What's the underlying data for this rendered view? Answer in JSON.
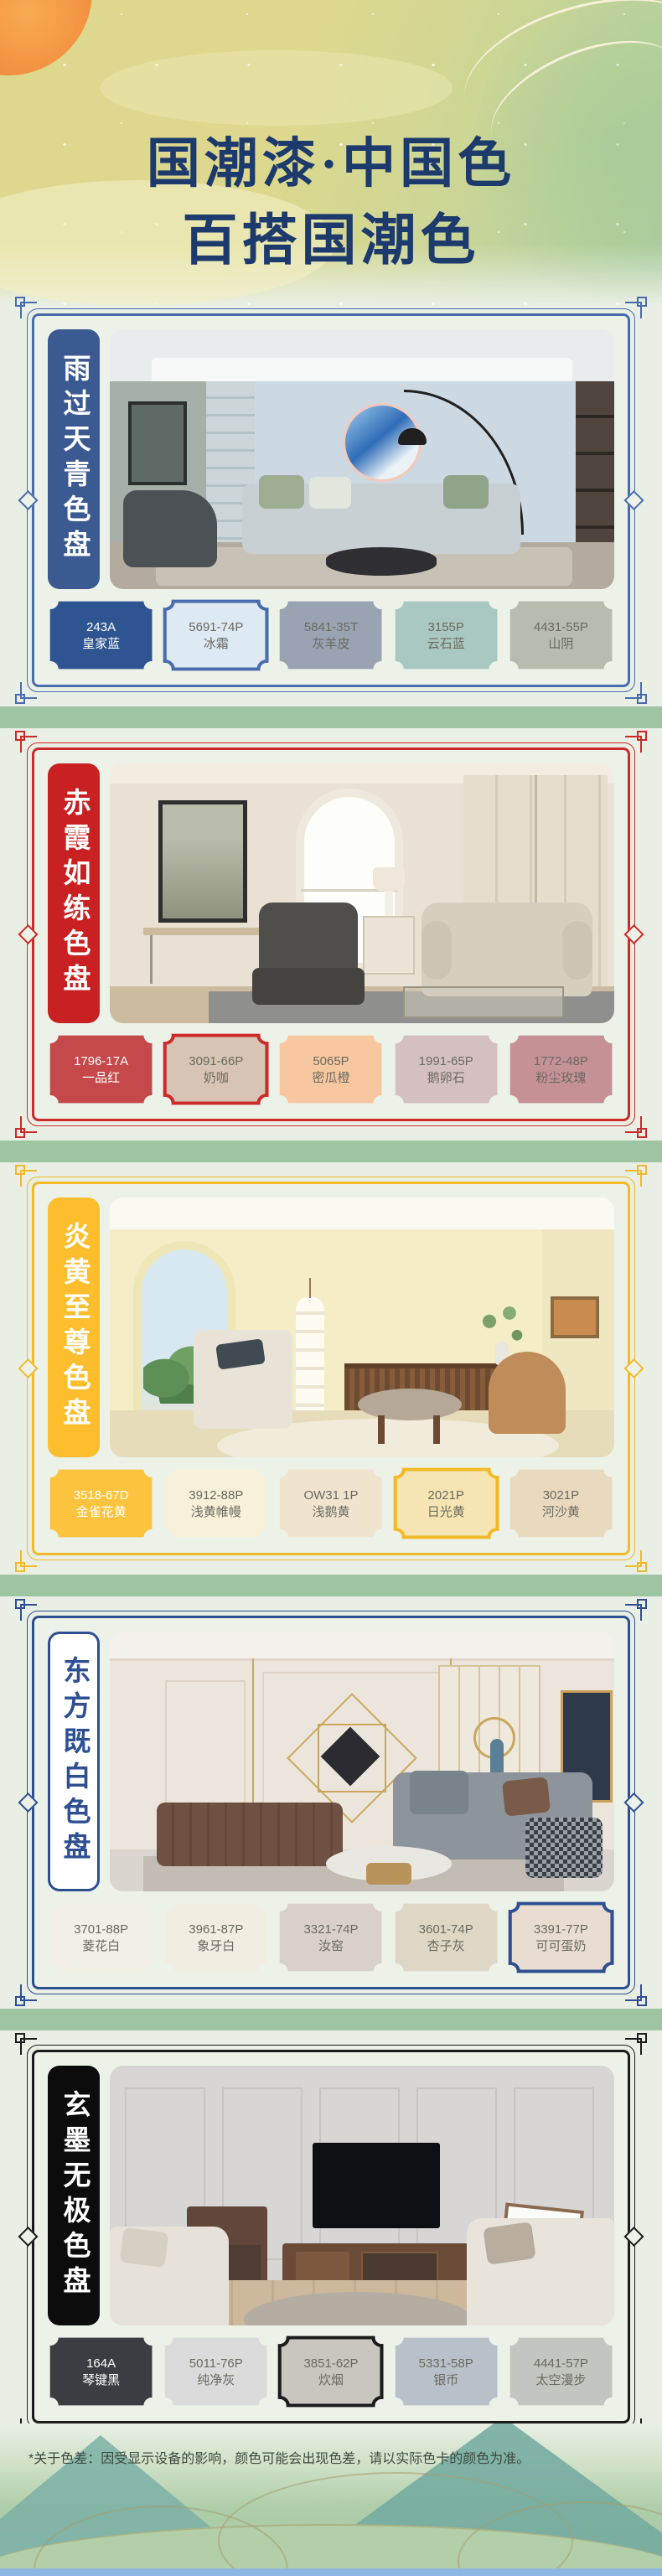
{
  "header": {
    "title_line1": "国潮漆·中国色",
    "title_line2": "百搭国潮色",
    "title_color": "#1d3a6d"
  },
  "sections": [
    {
      "title": "雨过天青色盘",
      "accent_color": "#4a6cae",
      "banner_bg": "#3b5a91",
      "banner_text_color": "#ffffff",
      "swatches": [
        {
          "code": "243A",
          "label": "皇家蓝",
          "color": "#2e5591",
          "text": "light",
          "highlighted": false
        },
        {
          "code": "5691-74P",
          "label": "冰霜",
          "color": "#dde9f3",
          "text": "dark",
          "highlighted": true
        },
        {
          "code": "5841-35T",
          "label": "灰羊皮",
          "color": "#99a3b1",
          "text": "dark",
          "highlighted": false
        },
        {
          "code": "3155P",
          "label": "云石蓝",
          "color": "#a9c8c1",
          "text": "dark",
          "highlighted": false
        },
        {
          "code": "4431-55P",
          "label": "山阴",
          "color": "#b7bcae",
          "text": "dark",
          "highlighted": false
        }
      ]
    },
    {
      "title": "赤霞如练色盘",
      "accent_color": "#cd2a2a",
      "banner_bg": "#c92121",
      "banner_text_color": "#ffffff",
      "swatches": [
        {
          "code": "1796-17A",
          "label": "一品红",
          "color": "#c5494b",
          "text": "light",
          "highlighted": false
        },
        {
          "code": "3091-66P",
          "label": "奶咖",
          "color": "#d8c4b5",
          "text": "dark",
          "highlighted": true
        },
        {
          "code": "5065P",
          "label": "密瓜橙",
          "color": "#f7c8a0",
          "text": "dark",
          "highlighted": false
        },
        {
          "code": "1991-65P",
          "label": "鹅卵石",
          "color": "#d4c0c1",
          "text": "dark",
          "highlighted": false
        },
        {
          "code": "1772-48P",
          "label": "粉尘玫瑰",
          "color": "#c69195",
          "text": "dark",
          "highlighted": false
        }
      ]
    },
    {
      "title": "炎黄至尊色盘",
      "accent_color": "#f2ba27",
      "banner_bg": "#fcbe2d",
      "banner_text_color": "#ffffff",
      "swatches": [
        {
          "code": "3518-67D",
          "label": "金雀花黄",
          "color": "#fcc33e",
          "text": "light",
          "highlighted": false
        },
        {
          "code": "3912-88P",
          "label": "浅黄帷幔",
          "color": "#f7f1d9",
          "text": "dark",
          "highlighted": false
        },
        {
          "code": "OW31 1P",
          "label": "浅鹅黄",
          "color": "#f0e4ce",
          "text": "dark",
          "highlighted": false
        },
        {
          "code": "2021P",
          "label": "日光黄",
          "color": "#f6e5b2",
          "text": "dark",
          "highlighted": true
        },
        {
          "code": "3021P",
          "label": "河沙黄",
          "color": "#e9dabf",
          "text": "dark",
          "highlighted": false
        }
      ]
    },
    {
      "title": "东方既白色盘",
      "accent_color": "#2e4f92",
      "banner_bg": "#ffffff",
      "banner_text_color": "#2e4f92",
      "swatches": [
        {
          "code": "3701-88P",
          "label": "菱花白",
          "color": "#f2f0e4",
          "text": "dark",
          "highlighted": false
        },
        {
          "code": "3961-87P",
          "label": "象牙白",
          "color": "#f1eee1",
          "text": "dark",
          "highlighted": false
        },
        {
          "code": "3321-74P",
          "label": "汝窑",
          "color": "#d9d1c9",
          "text": "dark",
          "highlighted": false
        },
        {
          "code": "3601-74P",
          "label": "杏子灰",
          "color": "#ded7c5",
          "text": "dark",
          "highlighted": false
        },
        {
          "code": "3391-77P",
          "label": "可可蛋奶",
          "color": "#e9ddd1",
          "text": "dark",
          "highlighted": true
        }
      ]
    },
    {
      "title": "玄墨无极色盘",
      "accent_color": "#1b1b1b",
      "banner_bg": "#0c0c0c",
      "banner_text_color": "#ffffff",
      "swatches": [
        {
          "code": "164A",
          "label": "琴键黑",
          "color": "#3a3e42",
          "text": "light",
          "highlighted": false
        },
        {
          "code": "5011-76P",
          "label": "纯净灰",
          "color": "#dbdbdb",
          "text": "dark",
          "highlighted": false
        },
        {
          "code": "3851-62P",
          "label": "炊烟",
          "color": "#c9c6bf",
          "text": "dark",
          "highlighted": true
        },
        {
          "code": "5331-58P",
          "label": "银币",
          "color": "#b8c1c9",
          "text": "dark",
          "highlighted": false
        },
        {
          "code": "4441-57P",
          "label": "太空漫步",
          "color": "#c3c5c1",
          "text": "dark",
          "highlighted": false
        }
      ]
    }
  ],
  "footer": {
    "disclaimer": "*关于色差：因受显示设备的影响，颜色可能会出现色差，请以实际色卡的颜色为准。"
  }
}
